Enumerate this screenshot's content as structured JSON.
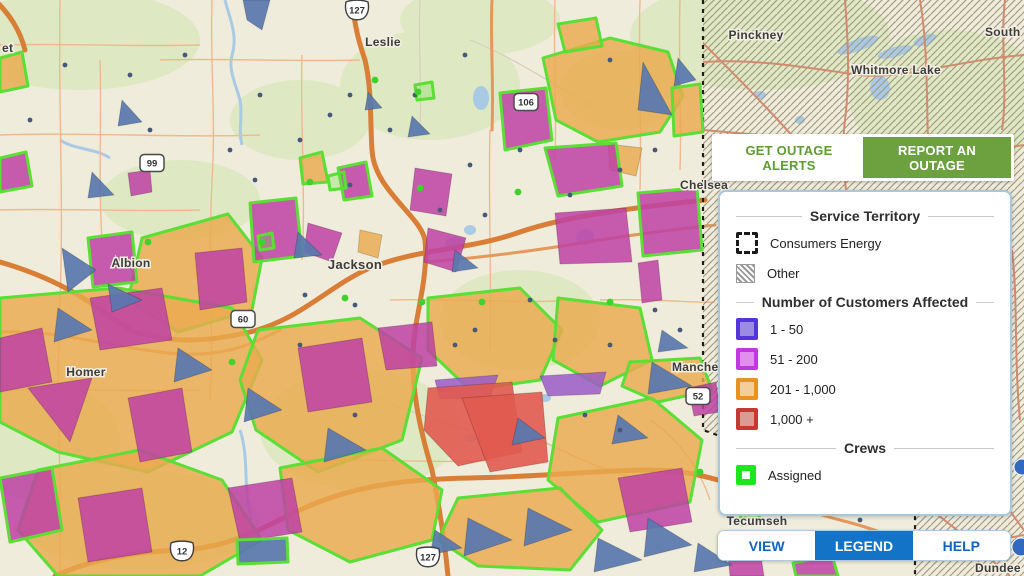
{
  "ui": {
    "top_buttons": {
      "alerts": "GET OUTAGE ALERTS",
      "report": "REPORT AN OUTAGE"
    },
    "legend": {
      "territory_title": "Service Territory",
      "territory_items": [
        {
          "label": "Consumers Energy"
        },
        {
          "label": "Other"
        }
      ],
      "customers_title": "Number of Customers Affected",
      "customers_items": [
        {
          "label": "1 - 50",
          "border": "#5436d8",
          "fill": "#9b8be3"
        },
        {
          "label": "51 - 200",
          "border": "#c238df",
          "fill": "#e18fec"
        },
        {
          "label": "201 - 1,000",
          "border": "#e89220",
          "fill": "#f3ce9a"
        },
        {
          "label": "1,000 +",
          "border": "#c23a33",
          "fill": "#db9b94"
        }
      ],
      "crews_title": "Crews",
      "crews_items": [
        {
          "label": "Assigned",
          "border": "#1de61d",
          "fill": "#ffffff"
        }
      ]
    },
    "tabs": [
      {
        "label": "VIEW",
        "active": false
      },
      {
        "label": "LEGEND",
        "active": true
      },
      {
        "label": "HELP",
        "active": false
      }
    ]
  },
  "map": {
    "palette": {
      "base": "#efecdb",
      "green_patch": "#dee8c2",
      "water": "#a9cae4",
      "road_minor": "#efb98d",
      "road_gray": "#d5cfbd",
      "road_medium": "#e5975c",
      "road_main": "#d97e36",
      "road_hatched": "#df8668",
      "hatch_line": "#a59c87",
      "boundary": "#1d1d1d",
      "orange": "#eaa94e",
      "magenta": "#be41a4",
      "blue": "#5877af",
      "red": "#e15a4f",
      "violet": "#9a5cc8",
      "green_outline": "#5bde35",
      "dot_gray": "#46597b",
      "dot_green": "#3fd22b",
      "marker_blue": "#3069bf",
      "label_color": "#3c3c3c",
      "label_halo": "#f2efe2"
    },
    "towns": [
      {
        "t": "et",
        "x": 2,
        "y": 52,
        "a": "start",
        "s": 12
      },
      {
        "t": "Leslie",
        "x": 383,
        "y": 46,
        "a": "middle",
        "s": 12
      },
      {
        "t": "Jackson",
        "x": 355,
        "y": 269,
        "a": "middle",
        "s": 13
      },
      {
        "t": "Albion",
        "x": 131,
        "y": 267,
        "a": "middle",
        "s": 12
      },
      {
        "t": "Homer",
        "x": 86,
        "y": 376,
        "a": "middle",
        "s": 12
      },
      {
        "t": "Pinckney",
        "x": 756,
        "y": 39,
        "a": "middle",
        "s": 12
      },
      {
        "t": "Whitmore Lake",
        "x": 896,
        "y": 74,
        "a": "middle",
        "s": 12
      },
      {
        "t": "South",
        "x": 985,
        "y": 36,
        "a": "start",
        "s": 12
      },
      {
        "t": "Chelsea",
        "x": 680,
        "y": 189,
        "a": "start",
        "s": 12
      },
      {
        "t": "Manche",
        "x": 672,
        "y": 371,
        "a": "start",
        "s": 12
      },
      {
        "t": "Tecumseh",
        "x": 757,
        "y": 525,
        "a": "middle",
        "s": 12
      },
      {
        "t": "Dundee",
        "x": 975,
        "y": 572,
        "a": "start",
        "s": 12
      }
    ],
    "shields": [
      {
        "k": "us",
        "n": "127",
        "x": 357,
        "y": 10
      },
      {
        "k": "us",
        "n": "12",
        "x": 182,
        "y": 551
      },
      {
        "k": "us",
        "n": "127",
        "x": 428,
        "y": 557
      },
      {
        "k": "st",
        "n": "99",
        "x": 152,
        "y": 163
      },
      {
        "k": "st",
        "n": "106",
        "x": 526,
        "y": 102
      },
      {
        "k": "st",
        "n": "60",
        "x": 243,
        "y": 319
      },
      {
        "k": "st",
        "n": "52",
        "x": 698,
        "y": 396
      }
    ],
    "green_patches": [
      [
        80,
        40,
        120,
        50
      ],
      [
        430,
        85,
        90,
        55
      ],
      [
        300,
        120,
        70,
        40
      ],
      [
        180,
        200,
        80,
        40
      ],
      [
        520,
        320,
        80,
        50
      ],
      [
        360,
        430,
        100,
        60
      ],
      [
        140,
        520,
        120,
        50
      ],
      [
        620,
        90,
        60,
        40
      ],
      [
        760,
        35,
        130,
        55
      ],
      [
        950,
        100,
        100,
        70
      ],
      [
        480,
        20,
        80,
        35
      ],
      [
        40,
        440,
        80,
        60
      ]
    ],
    "water_ellipses": [
      [
        481,
        98,
        8,
        12,
        0
      ],
      [
        455,
        244,
        10,
        7,
        0
      ],
      [
        470,
        230,
        6,
        5,
        0
      ],
      [
        585,
        237,
        9,
        8,
        0
      ],
      [
        545,
        398,
        6,
        4,
        0
      ],
      [
        858,
        45,
        22,
        6,
        -20
      ],
      [
        895,
        52,
        18,
        5,
        -15
      ],
      [
        925,
        40,
        12,
        5,
        -20
      ],
      [
        880,
        88,
        10,
        12,
        0
      ],
      [
        760,
        95,
        6,
        4,
        0
      ],
      [
        800,
        120,
        5,
        4,
        0
      ],
      [
        470,
        438,
        6,
        4,
        0
      ]
    ],
    "water_paths": [
      "M225,0 C230,20 238,35 232,55 C228,70 236,85 240,100 C243,115 238,130 242,145",
      "M240,430 C250,460 242,490 252,520",
      "M60,140 C75,150 95,148 110,158"
    ],
    "roads_minor": [
      "M60,0 C58,100 64,200 60,300 C56,400 62,500 60,576",
      "M212,0 C210,60 216,120 212,180 C208,260 214,330 210,400",
      "M302,55 C300,120 306,200 302,260",
      "M490,130 C488,200 492,280 490,350",
      "M640,0 C638,60 642,120 640,190",
      "M555,0 C553,50 557,110 555,160",
      "M160,60 C220,58 300,62 360,60",
      "M0,135 C80,132 180,138 260,135",
      "M0,45 C60,43 130,47 200,45",
      "M390,300 C450,298 520,304 580,300",
      "M0,390 C60,388 130,392 200,390",
      "M300,460 C360,458 430,464 500,460",
      "M600,300 C660,298 700,304 715,302",
      "M650,420 C680,440 700,470 710,500",
      "M100,60 C102,120 98,180 102,240",
      "M0,210 C60,208 130,212 200,210",
      "M520,430 C560,450 600,470 640,480",
      "M680,0 C678,50 682,110 680,170"
    ],
    "roads_gray": [
      "M420,0 C418,40 422,90 420,130",
      "M470,40 C520,60 560,90 600,110",
      "M330,380 C380,400 430,420 470,430"
    ],
    "roads_medium": [
      "M0,332 C60,330 100,345 160,352 C220,360 250,345 280,330",
      "M425,262 C480,258 540,250 600,240 C650,232 690,228 715,225",
      "M492,0 C490,40 494,80 492,130",
      "M715,480 C760,492 800,510 840,520 C880,530 900,540 915,545"
    ],
    "roads_main": [
      "M0,262 C80,285 110,320 135,332 C180,345 215,340 250,332 C300,320 330,285 370,268 C420,248 470,250 520,232 C570,215 640,207 705,200",
      "M352,0 C355,30 360,45 365,60 C372,90 370,120 372,150 C374,190 420,215 425,240 C428,270 420,300 415,330 C408,380 420,430 432,470 C440,510 445,545 448,576",
      "M55,576 C90,560 130,552 180,550 C230,548 262,528 300,510 C360,482 420,479 470,478 C540,477 600,470 650,470 C680,470 700,475 718,480",
      "M-5,0 C10,15 20,30 25,50"
    ],
    "roads_hatched": [
      "M703,62 C760,58 820,70 860,75 C900,80 960,60 1024,55",
      "M845,0 C848,40 850,80 845,120 C840,160 848,200 850,230",
      "M703,130 C760,135 820,140 880,150 C940,160 990,150 1024,145",
      "M920,0 C930,60 925,120 930,180",
      "M1005,0 C1000,40 1008,90 1002,130",
      "M700,40 C740,80 790,130 830,180",
      "M915,500 C950,520 990,560 1010,576",
      "M920,540 C960,545 1000,540 1024,535",
      "M960,420 C980,460 1000,500 1024,530",
      "M1012,250 C1018,300 1014,360 1020,420"
    ],
    "boundary_path": "M703,0 L703,430 L915,505 L915,576",
    "hatch_region": "703,0 1024,0 1024,576 915,576 915,505 703,430",
    "polygons": [
      {
        "c": "o",
        "g": 1,
        "p": "543,58 610,38 668,52 683,96 660,132 598,142 556,120"
      },
      {
        "c": "o",
        "g": 1,
        "p": "558,24 596,18 602,46 565,52"
      },
      {
        "c": "o",
        "g": 1,
        "p": "672,88 700,84 703,132 674,136"
      },
      {
        "c": "o",
        "g": 1,
        "p": "300,158 322,152 328,182 303,184"
      },
      {
        "c": "o",
        "g": 1,
        "p": "142,238 228,214 262,258 252,310 178,332 128,300"
      },
      {
        "c": "o",
        "g": 1,
        "p": "0,58 22,52 28,86 0,92"
      },
      {
        "c": "o",
        "g": 1,
        "p": "0,298 118,288 232,308 262,360 232,432 148,472 58,452 0,422"
      },
      {
        "c": "o",
        "g": 1,
        "p": "258,330 360,318 422,358 402,440 318,472 256,430 240,380"
      },
      {
        "c": "o",
        "g": 1,
        "p": "38,470 140,450 222,480 262,540 200,576 58,576 18,530"
      },
      {
        "c": "o",
        "g": 1,
        "p": "280,468 382,448 442,490 432,540 350,562 288,530"
      },
      {
        "c": "o",
        "g": 1,
        "p": "428,298 520,288 562,330 540,380 470,390 428,350"
      },
      {
        "c": "o",
        "g": 1,
        "p": "558,298 640,308 652,360 600,386 553,360"
      },
      {
        "c": "o",
        "g": 1,
        "p": "558,418 652,398 702,440 690,502 598,522 548,480"
      },
      {
        "c": "o",
        "g": 1,
        "p": "458,498 560,488 602,530 570,570 478,566 438,540"
      },
      {
        "c": "o",
        "g": 1,
        "p": "630,362 700,358 712,390 658,402 622,386"
      },
      {
        "c": "o",
        "g": 0,
        "p": "608,144 642,148 636,176 610,170"
      },
      {
        "c": "o",
        "g": 0,
        "p": "360,230 382,235 378,258 358,252"
      },
      {
        "c": "m",
        "g": 1,
        "p": "500,93 546,88 552,140 505,150"
      },
      {
        "c": "m",
        "g": 1,
        "p": "545,148 616,143 622,186 558,196"
      },
      {
        "c": "m",
        "g": 1,
        "p": "638,193 697,188 702,250 643,256"
      },
      {
        "c": "m",
        "g": 1,
        "p": "250,203 296,198 302,256 254,262"
      },
      {
        "c": "m",
        "g": 1,
        "p": "88,238 132,232 137,282 93,287"
      },
      {
        "c": "m",
        "g": 1,
        "p": "0,158 26,152 32,186 0,192"
      },
      {
        "c": "m",
        "g": 1,
        "p": "338,168 366,162 372,196 344,200"
      },
      {
        "c": "m",
        "g": 1,
        "p": "0,478 52,468 62,530 10,542"
      },
      {
        "c": "m",
        "g": 1,
        "p": "793,563 832,555 838,576 796,576"
      },
      {
        "c": "m",
        "g": 0,
        "p": "415,168 452,174 446,216 410,210"
      },
      {
        "c": "m",
        "g": 0,
        "p": "555,213 626,208 632,262 560,264"
      },
      {
        "c": "m",
        "g": 0,
        "p": "308,223 342,233 332,262 304,252"
      },
      {
        "c": "m",
        "g": 0,
        "p": "428,228 466,238 456,272 424,262"
      },
      {
        "c": "m",
        "g": 0,
        "p": "195,253 242,248 247,302 200,310"
      },
      {
        "c": "m",
        "g": 0,
        "p": "128,173 150,170 152,192 131,196"
      },
      {
        "c": "m",
        "g": 0,
        "p": "90,298 162,288 172,340 100,350"
      },
      {
        "c": "m",
        "g": 0,
        "p": "28,388 92,378 70,442"
      },
      {
        "c": "m",
        "g": 0,
        "p": "128,398 182,388 192,452 140,462"
      },
      {
        "c": "m",
        "g": 0,
        "p": "0,338 42,328 52,382 0,392"
      },
      {
        "c": "m",
        "g": 0,
        "p": "298,348 362,338 372,402 308,412"
      },
      {
        "c": "m",
        "g": 0,
        "p": "378,328 432,322 437,366 386,370"
      },
      {
        "c": "m",
        "g": 0,
        "p": "78,498 142,488 152,552 88,562"
      },
      {
        "c": "m",
        "g": 0,
        "p": "228,488 292,478 302,532 240,542"
      },
      {
        "c": "m",
        "g": 0,
        "p": "618,478 682,468 692,522 630,532"
      },
      {
        "c": "m",
        "g": 0,
        "p": "688,388 716,382 720,412 694,416"
      },
      {
        "c": "m",
        "g": 0,
        "p": "638,263 658,260 662,300 642,303"
      },
      {
        "c": "m",
        "g": 0,
        "p": "728,556 760,550 764,576 730,576"
      },
      {
        "c": "v",
        "g": 0,
        "p": "435,380 498,375 490,398 440,399"
      },
      {
        "c": "v",
        "g": 0,
        "p": "540,376 606,372 600,394 548,396"
      },
      {
        "c": "r",
        "g": 0,
        "p": "428,388 512,382 522,452 458,466 424,430"
      },
      {
        "c": "r",
        "g": 0,
        "p": "462,398 542,392 548,462 490,472"
      },
      {
        "c": "b",
        "g": 0,
        "p": "643,62 672,115 638,110"
      },
      {
        "c": "b",
        "g": 0,
        "p": "678,58 696,80 674,86"
      },
      {
        "c": "b",
        "g": 0,
        "p": "243,0 270,0 262,30 247,20"
      },
      {
        "c": "b",
        "g": 0,
        "p": "298,232 322,255 294,258"
      },
      {
        "c": "b",
        "g": 0,
        "p": "62,248 96,270 68,292"
      },
      {
        "c": "b",
        "g": 0,
        "p": "108,284 142,300 112,312"
      },
      {
        "c": "b",
        "g": 0,
        "p": "58,308 92,330 54,342"
      },
      {
        "c": "b",
        "g": 0,
        "p": "178,348 212,370 174,382"
      },
      {
        "c": "b",
        "g": 0,
        "p": "248,388 282,410 244,422"
      },
      {
        "c": "b",
        "g": 0,
        "p": "328,428 366,450 324,462"
      },
      {
        "c": "b",
        "g": 0,
        "p": "92,172 114,195 88,198"
      },
      {
        "c": "b",
        "g": 0,
        "p": "652,362 692,386 648,394"
      },
      {
        "c": "b",
        "g": 0,
        "p": "468,518 512,540 464,556"
      },
      {
        "c": "b",
        "g": 0,
        "p": "528,508 572,530 524,546"
      },
      {
        "c": "b",
        "g": 1,
        "p": "237,540 287,538 288,562 238,564"
      },
      {
        "c": "b",
        "g": 0,
        "p": "598,538 642,560 594,572"
      },
      {
        "c": "b",
        "g": 0,
        "p": "648,518 692,545 644,557"
      },
      {
        "c": "b",
        "g": 0,
        "p": "698,543 732,565 694,572"
      },
      {
        "c": "b",
        "g": 0,
        "p": "368,92 382,108 365,110"
      },
      {
        "c": "b",
        "g": 0,
        "p": "412,116 430,134 408,137"
      },
      {
        "c": "b",
        "g": 0,
        "p": "122,100 142,122 118,126"
      },
      {
        "c": "b",
        "g": 0,
        "p": "455,250 478,268 452,272"
      },
      {
        "c": "b",
        "g": 0,
        "p": "662,330 688,348 658,352"
      },
      {
        "c": "b",
        "g": 0,
        "p": "618,415 648,438 612,444"
      },
      {
        "c": "b",
        "g": 0,
        "p": "518,418 545,438 512,445"
      },
      {
        "c": "b",
        "g": 0,
        "p": "435,530 462,548 430,555"
      },
      {
        "c": "g",
        "g": 1,
        "p": "328,176 344,172 346,188 330,190"
      },
      {
        "c": "g",
        "g": 1,
        "p": "415,85 432,82 434,98 417,100"
      },
      {
        "c": "g",
        "g": 1,
        "p": "258,236 272,233 274,248 260,250"
      },
      {
        "c": "g",
        "g": 1,
        "p": "740,512 758,508 760,522 742,525"
      }
    ],
    "dots_gray": [
      [
        130,
        75
      ],
      [
        185,
        55
      ],
      [
        260,
        95
      ],
      [
        330,
        115
      ],
      [
        300,
        140
      ],
      [
        65,
        65
      ],
      [
        30,
        120
      ],
      [
        150,
        130
      ],
      [
        230,
        150
      ],
      [
        465,
        55
      ],
      [
        610,
        60
      ],
      [
        655,
        150
      ],
      [
        470,
        165
      ],
      [
        520,
        150
      ],
      [
        350,
        95
      ],
      [
        390,
        130
      ],
      [
        415,
        95
      ],
      [
        570,
        195
      ],
      [
        620,
        170
      ],
      [
        305,
        295
      ],
      [
        355,
        305
      ],
      [
        300,
        345
      ],
      [
        475,
        330
      ],
      [
        530,
        300
      ],
      [
        555,
        340
      ],
      [
        610,
        345
      ],
      [
        350,
        185
      ],
      [
        255,
        180
      ],
      [
        440,
        210
      ],
      [
        485,
        215
      ],
      [
        655,
        310
      ],
      [
        680,
        330
      ],
      [
        585,
        415
      ],
      [
        620,
        430
      ],
      [
        355,
        415
      ],
      [
        455,
        345
      ],
      [
        745,
        500
      ],
      [
        860,
        520
      ],
      [
        775,
        555
      ]
    ],
    "dots_green": [
      [
        375,
        80
      ],
      [
        420,
        188
      ],
      [
        345,
        298
      ],
      [
        262,
        242
      ],
      [
        422,
        302
      ],
      [
        518,
        192
      ],
      [
        610,
        302
      ],
      [
        482,
        302
      ],
      [
        148,
        242
      ],
      [
        232,
        362
      ],
      [
        700,
        472
      ],
      [
        745,
        520
      ],
      [
        310,
        182
      ],
      [
        418,
        92
      ]
    ],
    "markers_blue": [
      [
        1022,
        467,
        8
      ],
      [
        1021,
        547,
        9
      ]
    ]
  }
}
